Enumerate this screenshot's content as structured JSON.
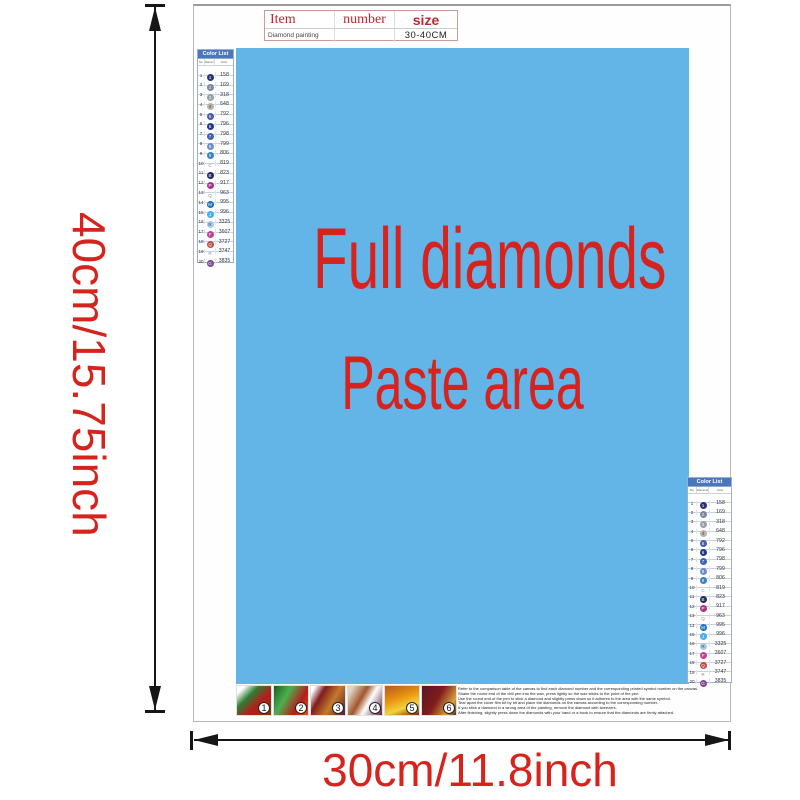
{
  "dimensions": {
    "height_label": "40cm/15.75inch",
    "width_label": "30cm/11.8inch",
    "accent_color": "#d6231e"
  },
  "item_table": {
    "col_item": "Item",
    "col_number": "number",
    "col_size": "size",
    "row_item": "Diamond painting",
    "row_number": "",
    "row_size": "30-40CM"
  },
  "paste_area": {
    "line1": "Full diamonds",
    "line2": "Paste area",
    "bg_color": "#63b5e8",
    "text_color": "#d6231e"
  },
  "color_list": {
    "title": "Color List",
    "columns": [
      "No.",
      "Diamond",
      "Color"
    ],
    "rows": [
      {
        "no": "1",
        "symbol": "1",
        "circle": "#2a3170",
        "symbol_color": "#ffffff",
        "code": "158"
      },
      {
        "no": "2",
        "symbol": "2",
        "circle": "#7d889e",
        "symbol_color": "#eaeaea",
        "code": "169"
      },
      {
        "no": "3",
        "symbol": "3",
        "circle": "#9aa0a6",
        "symbol_color": "#f2f2f2",
        "code": "318"
      },
      {
        "no": "4",
        "symbol": "4",
        "circle": "#b9b3a7",
        "symbol_color": "#4a4a4a",
        "code": "648"
      },
      {
        "no": "5",
        "symbol": "5",
        "circle": "#4a5aa8",
        "symbol_color": "#ffffff",
        "code": "792"
      },
      {
        "no": "6",
        "symbol": "6",
        "circle": "#1f3a8c",
        "symbol_color": "#ffffff",
        "code": "796"
      },
      {
        "no": "7",
        "symbol": "7",
        "circle": "#3f62b5",
        "symbol_color": "#ffffff",
        "code": "798"
      },
      {
        "no": "8",
        "symbol": "8",
        "circle": "#6c8cc8",
        "symbol_color": "#ffffff",
        "code": "799"
      },
      {
        "no": "9",
        "symbol": "9",
        "circle": "#3a7fc2",
        "symbol_color": "#ffffff",
        "code": "806"
      },
      {
        "no": "10",
        "symbol": "C",
        "circle": "",
        "symbol_color": "#8a8a8a",
        "code": "819"
      },
      {
        "no": "11",
        "symbol": "B",
        "circle": "#1c2a5e",
        "symbol_color": "#ffffff",
        "code": "823"
      },
      {
        "no": "12",
        "symbol": "P",
        "circle": "#a93086",
        "symbol_color": "#ffffff",
        "code": "917"
      },
      {
        "no": "13",
        "symbol": "Q",
        "circle": "",
        "symbol_color": "#8a8a8a",
        "code": "963"
      },
      {
        "no": "14",
        "symbol": "M",
        "circle": "#1d6fc0",
        "symbol_color": "#ffffff",
        "code": "995"
      },
      {
        "no": "15",
        "symbol": "J",
        "circle": "#45b1e8",
        "symbol_color": "#ffffff",
        "code": "996"
      },
      {
        "no": "16",
        "symbol": "R",
        "circle": "#a8c9e8",
        "symbol_color": "#33567a",
        "code": "3325"
      },
      {
        "no": "17",
        "symbol": "F",
        "circle": "#c2428f",
        "symbol_color": "#ffffff",
        "code": "3607"
      },
      {
        "no": "18",
        "symbol": "Q",
        "circle": "#bf4a41",
        "symbol_color": "#ffffff",
        "code": "3727"
      },
      {
        "no": "19",
        "symbol": "R",
        "circle": "",
        "symbol_color": "#8a8a8a",
        "code": "3747"
      },
      {
        "no": "20",
        "symbol": "G",
        "circle": "#7d4a8c",
        "symbol_color": "#ffffff",
        "code": "3835"
      }
    ]
  },
  "steps": {
    "items": [
      {
        "label": "1",
        "gradient": "linear-gradient(135deg,#ffffff 12%,#2e7d32 35%,#b71c1c 62%,#7b3f00 100%)"
      },
      {
        "label": "2",
        "gradient": "linear-gradient(120deg,#1b5e20 0%,#4caf50 35%,#b71c1c 70%,#e65100 100%)"
      },
      {
        "label": "3",
        "gradient": "linear-gradient(120deg,#ffffff 8%,#7f1d1d 30%,#c47a2b 60%,#5c1a2e 100%)"
      },
      {
        "label": "4",
        "gradient": "linear-gradient(120deg,#e0d6c8 10%,#a2552b 40%,#ffffff 60%,#5c1a3a 100%)"
      },
      {
        "label": "5",
        "gradient": "linear-gradient(160deg,#b35a1f 0%,#e8920f 40%,#f4d23c 70%,#7a2410 100%)"
      },
      {
        "label": "6",
        "gradient": "linear-gradient(120deg,#5c1424 0%,#7f1d1d 45%,#d9a23c 80%,#4a3220 100%)"
      }
    ]
  },
  "instructions": {
    "lines": [
      "Refer to the comparison table of the canvas to find each diamond number and the corresponding printed symbol number on the canvas.",
      "Shake the round end of the drill pen into the wax, press lightly so the wax sticks to the point of the pen.",
      "Use the round end of the pen to stick a diamond and slightly press down so it adheres to the area with the same symbol.",
      "Tear apart the cover film bit by bit and place the diamonds on the canvas according to the corresponding number.",
      "If you stick a diamond in a wrong area of the painting, remove the diamond with tweezers.",
      "After finishing, slightly press down the diamonds with your hand or a book to ensure that the diamonds are firmly attached."
    ]
  }
}
